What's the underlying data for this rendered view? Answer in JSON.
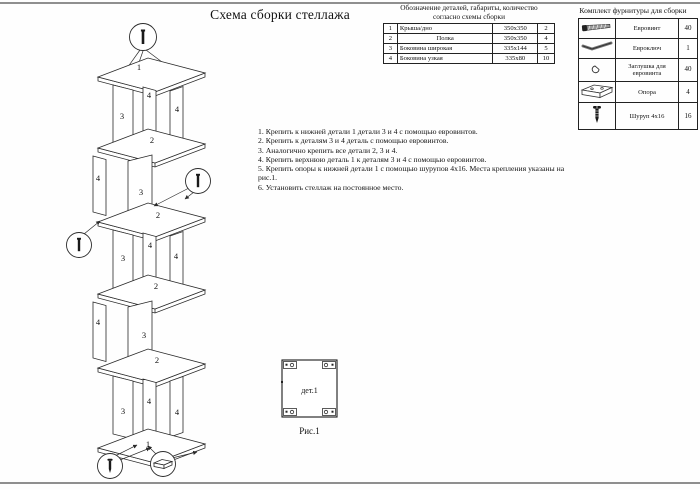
{
  "page": {
    "title": "Схема сборки стеллажа"
  },
  "parts_table": {
    "title_line1": "Обозначение деталей, габариты, количество",
    "title_line2": "согласно схемы сборки",
    "rows": [
      {
        "num": "1",
        "name": "Крыша/дно",
        "size": "350х350",
        "qty": "2"
      },
      {
        "num": "2",
        "name": "Полка",
        "size": "350х350",
        "qty": "4"
      },
      {
        "num": "3",
        "name": "Боковина широкая",
        "size": "335х144",
        "qty": "5"
      },
      {
        "num": "4",
        "name": "Боковина узкая",
        "size": "335х80",
        "qty": "10"
      }
    ]
  },
  "hardware_table": {
    "title": "Комплект фурнитуры для сборки",
    "rows": [
      {
        "icon": "euro-screw-icon",
        "name": "Евровинт",
        "qty": "40"
      },
      {
        "icon": "euro-key-icon",
        "name": "Евроключ",
        "qty": "1"
      },
      {
        "icon": "plug-icon",
        "name": "Заглушка для евровинта",
        "qty": "40"
      },
      {
        "icon": "support-icon",
        "name": "Опора",
        "qty": "4"
      },
      {
        "icon": "screw-icon",
        "name": "Шуруп 4х16",
        "qty": "16"
      }
    ]
  },
  "instructions": {
    "items": [
      "1. Крепить к нижней детали 1 детали 3 и 4 с помощью евровинтов.",
      "2. Крепить к деталям 3 и 4 деталь с помощью евровинтов.",
      "3. Аналогично крепить все детали 2, 3 и 4.",
      "4. Крепить верхнюю деталь 1 к деталям 3 и 4 с помощью евровинтов.",
      "5. Крепить опоры к нижней детали 1 с помощью шурупов 4х16. Места крепления указаны на рис.1.",
      "6. Установить стеллаж на постоянное место."
    ]
  },
  "diagram": {
    "part_labels": [
      "1",
      "3",
      "4",
      "4",
      "2",
      "4",
      "3",
      "2",
      "3",
      "4",
      "4",
      "2",
      "4",
      "3",
      "2",
      "3",
      "4",
      "4",
      "1"
    ]
  },
  "figure": {
    "label": "дет.1",
    "caption": "Рис.1"
  },
  "colors": {
    "line": "#2a2a2a",
    "edge": "#8f8f8f"
  }
}
